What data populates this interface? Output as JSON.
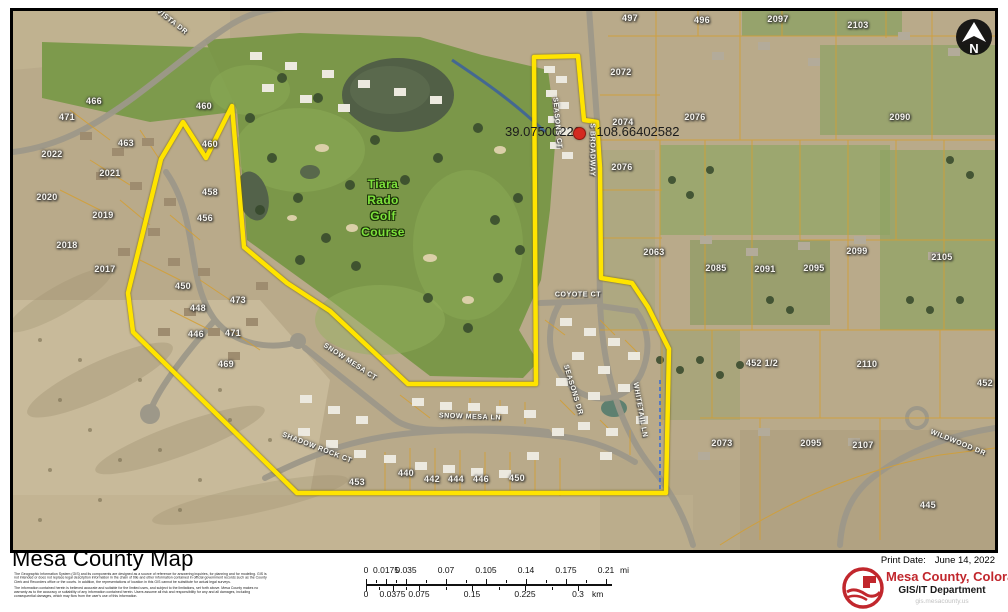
{
  "colors": {
    "boundary": "#ffe400",
    "parcel_line": "#d39f33",
    "brand_red": "#c1272d",
    "golf_label": "#7de23c",
    "marker_red": "#d42a20"
  },
  "map": {
    "north_label": "N",
    "golf_label": {
      "lines": [
        "Tiara",
        "Rado",
        "Golf",
        "Course"
      ]
    },
    "coordinate_label": {
      "lat": "39.07500226",
      "lon": "-108.66402582"
    },
    "parcel_labels": [
      {
        "t": "466",
        "x": 94,
        "y": 101
      },
      {
        "t": "460",
        "x": 204,
        "y": 106
      },
      {
        "t": "460",
        "x": 210,
        "y": 144
      },
      {
        "t": "458",
        "x": 210,
        "y": 192
      },
      {
        "t": "471",
        "x": 67,
        "y": 117
      },
      {
        "t": "463",
        "x": 126,
        "y": 143
      },
      {
        "t": "2022",
        "x": 52,
        "y": 154
      },
      {
        "t": "2021",
        "x": 110,
        "y": 173
      },
      {
        "t": "2020",
        "x": 47,
        "y": 197
      },
      {
        "t": "2019",
        "x": 103,
        "y": 215
      },
      {
        "t": "2018",
        "x": 67,
        "y": 245
      },
      {
        "t": "2017",
        "x": 105,
        "y": 269
      },
      {
        "t": "456",
        "x": 205,
        "y": 218
      },
      {
        "t": "450",
        "x": 183,
        "y": 286
      },
      {
        "t": "448",
        "x": 198,
        "y": 308
      },
      {
        "t": "446",
        "x": 196,
        "y": 334
      },
      {
        "t": "473",
        "x": 238,
        "y": 300
      },
      {
        "t": "471",
        "x": 233,
        "y": 333
      },
      {
        "t": "469",
        "x": 226,
        "y": 364
      },
      {
        "t": "453",
        "x": 357,
        "y": 482
      },
      {
        "t": "440",
        "x": 406,
        "y": 473
      },
      {
        "t": "442",
        "x": 432,
        "y": 479
      },
      {
        "t": "444",
        "x": 456,
        "y": 479
      },
      {
        "t": "446",
        "x": 481,
        "y": 479
      },
      {
        "t": "450",
        "x": 517,
        "y": 478
      },
      {
        "t": "2072",
        "x": 621,
        "y": 72
      },
      {
        "t": "2074",
        "x": 623,
        "y": 122
      },
      {
        "t": "2076",
        "x": 622,
        "y": 167
      },
      {
        "t": "2076",
        "x": 695,
        "y": 117
      },
      {
        "t": "497",
        "x": 630,
        "y": 18
      },
      {
        "t": "496",
        "x": 702,
        "y": 20
      },
      {
        "t": "2097",
        "x": 778,
        "y": 19
      },
      {
        "t": "2103",
        "x": 858,
        "y": 25
      },
      {
        "t": "2090",
        "x": 900,
        "y": 117
      },
      {
        "t": "2063",
        "x": 654,
        "y": 252
      },
      {
        "t": "2085",
        "x": 716,
        "y": 268
      },
      {
        "t": "2091",
        "x": 765,
        "y": 269
      },
      {
        "t": "2095",
        "x": 814,
        "y": 268
      },
      {
        "t": "2099",
        "x": 857,
        "y": 251
      },
      {
        "t": "2105",
        "x": 942,
        "y": 257
      },
      {
        "t": "452 1/2",
        "x": 762,
        "y": 363
      },
      {
        "t": "2110",
        "x": 867,
        "y": 364
      },
      {
        "t": "452",
        "x": 985,
        "y": 383
      },
      {
        "t": "2073",
        "x": 722,
        "y": 443
      },
      {
        "t": "2095",
        "x": 811,
        "y": 443
      },
      {
        "t": "2107",
        "x": 863,
        "y": 445
      },
      {
        "t": "445",
        "x": 928,
        "y": 505
      }
    ],
    "street_labels": [
      {
        "t": "VISTA DR",
        "x": 172,
        "y": 22,
        "r": 38
      },
      {
        "t": "SNOW MESA CT",
        "x": 350,
        "y": 362,
        "r": 33
      },
      {
        "t": "SNOW MESA LN",
        "x": 470,
        "y": 417,
        "r": 2
      },
      {
        "t": "SHADOW ROCK CT",
        "x": 317,
        "y": 448,
        "r": 21
      },
      {
        "t": "COYOTE CT",
        "x": 578,
        "y": 295,
        "r": 0
      },
      {
        "t": "SEASONS DR",
        "x": 573,
        "y": 390,
        "r": 73
      },
      {
        "t": "SEASONS CT",
        "x": 557,
        "y": 123,
        "r": 85
      },
      {
        "t": "S BROADWAY",
        "x": 592,
        "y": 150,
        "r": 90
      },
      {
        "t": "WHITETAIL LN",
        "x": 640,
        "y": 410,
        "r": 80
      },
      {
        "t": "WILDWOOD DR",
        "x": 958,
        "y": 443,
        "r": 22
      }
    ]
  },
  "footer": {
    "title": "Mesa County Map",
    "disclaimer1": "The Geographic Information System (GIS) and its components are designed as a source of reference for answering inquiries, for planning and for modeling. GIS is not intended or does not replace legal description information in the chain of title and other information contained in official government records such as the County Clerk and Recorders office or the courts. In addition, the representations of location in this GIS cannot be substitute for actual legal surveys.",
    "disclaimer2": "The information contained herein is believed accurate and suitable for the limited uses, and subject to the limitations, set forth above. Mesa County makes no warranty as to the accuracy or suitability of any information contained herein. Users assume all risk and responsibility for any and all damages, including consequential damages, which may flow from the user's use of this information.",
    "scalebar": {
      "miles": {
        "labels": [
          "0",
          "0.0175",
          "0.035",
          "0.07",
          "0.105",
          "0.14",
          "0.175",
          "0.21"
        ],
        "max": 0.21,
        "unit": "mi"
      },
      "km": {
        "labels": [
          "0",
          "0.0375",
          "0.075",
          "0.15",
          "0.225",
          "0.3"
        ],
        "max": 0.3,
        "unit": "km"
      }
    },
    "print_date_label": "Print Date:",
    "print_date": "June 14, 2022",
    "org": "Mesa County, Colorado",
    "dept": "GIS/IT Department",
    "url": "gis.mesacounty.us"
  }
}
